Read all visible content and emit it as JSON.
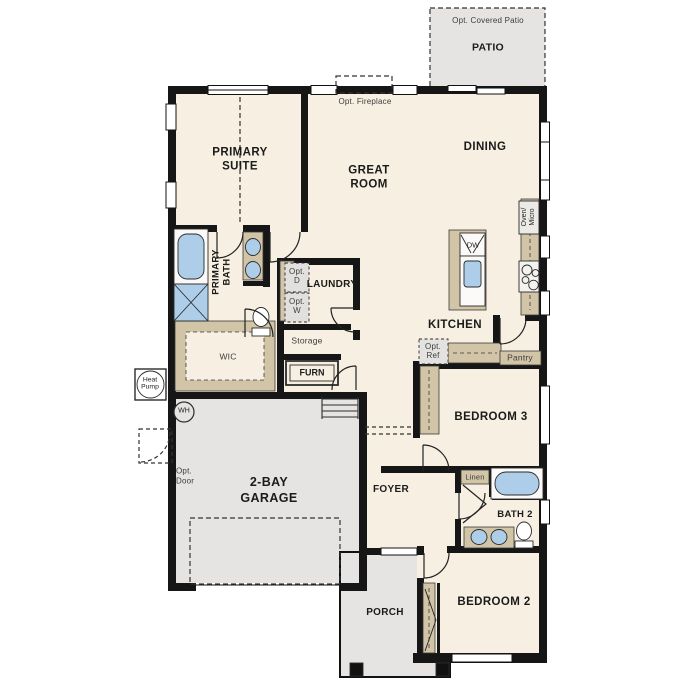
{
  "colors": {
    "floor": "#f7efe1",
    "outdoor": "#e5e4e2",
    "cabinet": "#d2c4a6",
    "water": "#aecde9",
    "wall": "#161616"
  },
  "rooms": {
    "patio": "PATIO",
    "primary_suite": "PRIMARY SUITE",
    "great_room": "GREAT ROOM",
    "dining": "DINING",
    "kitchen": "KITCHEN",
    "primary_bath": "PRIMARY BATH",
    "wic": "WIC",
    "laundry": "LAUNDRY",
    "storage": "Storage",
    "pantry": "Pantry",
    "garage": "2-BAY GARAGE",
    "foyer": "FOYER",
    "bedroom_3": "BEDROOM 3",
    "bath_2": "BATH 2",
    "bedroom_2": "BEDROOM 2",
    "porch": "PORCH",
    "linen": "Linen"
  },
  "options": {
    "covered_patio": "Opt. Covered Patio",
    "fireplace": "Opt. Fireplace",
    "refrigerator": "Opt. Ref",
    "dryer": "Opt. D",
    "washer": "Opt. W",
    "garage_side_door": "Opt. Door"
  },
  "equipment": {
    "dishwasher": "DW",
    "oven_micro": "Oven/ Micro",
    "furnace": "FURN",
    "water_heater": "WH",
    "heat_pump": "Heat Pump"
  }
}
